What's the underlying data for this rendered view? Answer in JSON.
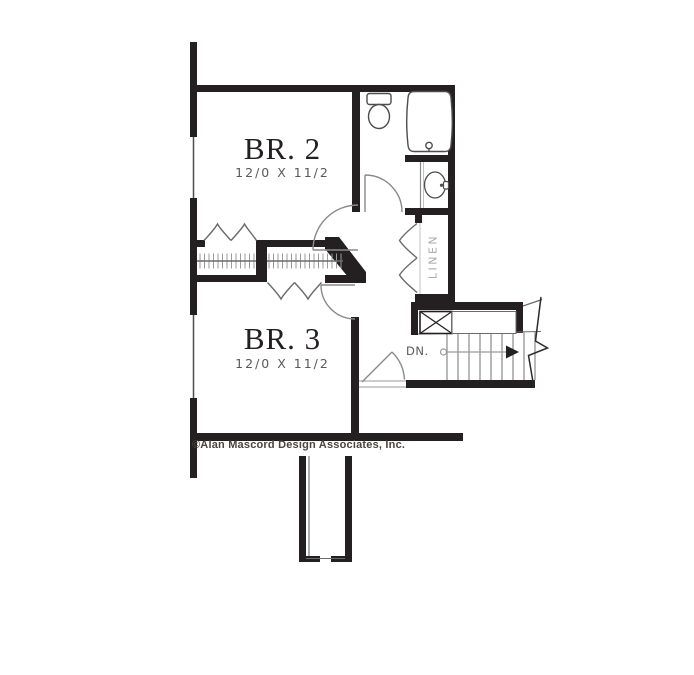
{
  "floorplan": {
    "background_color": "#ffffff",
    "wall_color": "#242021",
    "line_color": "#8a8a8c",
    "rooms": {
      "br2": {
        "label": "BR. 2",
        "dimensions": "12/0 X 11/2"
      },
      "br3": {
        "label": "BR. 3",
        "dimensions": "12/0 X 11/2"
      },
      "linen": {
        "label": "LINEN"
      },
      "stairs": {
        "label": "DN."
      }
    },
    "fixtures": [
      "toilet",
      "bathtub",
      "sink",
      "closet-rod",
      "closet-rod",
      "shelf-xbox",
      "chimney"
    ],
    "copyright": "©Alan Mascord Design Associates, Inc."
  }
}
